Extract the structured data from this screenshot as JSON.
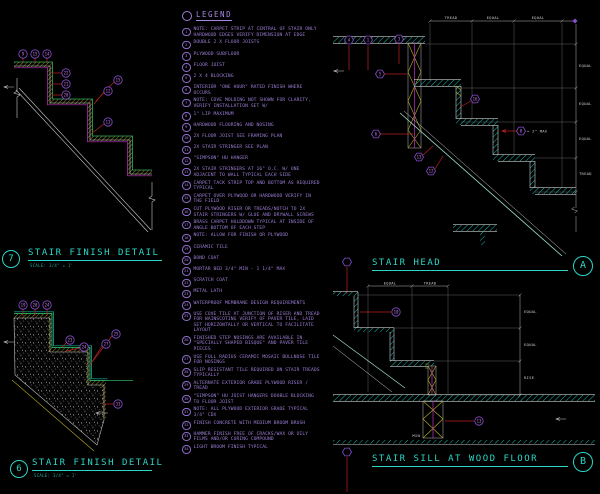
{
  "colors": {
    "background": "#000000",
    "title_cyan": "#2bd6c6",
    "legend_purple": "#9d7fd6",
    "balloon_purple": "#b05fd8",
    "leader_red": "#bb2222",
    "hatch_yellow": "#b9ae25",
    "line_white": "#c9c9c9",
    "tile_green": "#2fae5e",
    "line_magenta": "#c234c2"
  },
  "legend": {
    "title": "LEGEND",
    "items": [
      {
        "num": "1",
        "text": "NOTE: CARPET STRIP AT CENTRAL OF STAIR ONLY HARDWOOD EDGES VERIFY DIMENSION AT EDGE"
      },
      {
        "num": "2",
        "text": "DOUBLE 2 X FLOOR JOISTS"
      },
      {
        "num": "3",
        "text": "PLYWOOD SUBFLOOR"
      },
      {
        "num": "4",
        "text": "FLOOR JOIST"
      },
      {
        "num": "5",
        "text": "2 X 4 BLOCKING"
      },
      {
        "num": "6",
        "text": "INTERIOR \"ONE HOUR\" RATED FINISH WHERE OCCURS"
      },
      {
        "num": "7",
        "text": "NOTE: COVE MOLDING NOT SHOWN FOR CLARITY, VERIFY INSTALLATION SET W/"
      },
      {
        "num": "8",
        "text": "1\" LIP MAXIMUM"
      },
      {
        "num": "9",
        "text": "HARDWOOD FLOORING AND NOSING"
      },
      {
        "num": "10",
        "text": "2X FLOOR JOIST SEE FRAMING PLAN"
      },
      {
        "num": "11",
        "text": "2X STAIR STRINGER SEE PLAN"
      },
      {
        "num": "12",
        "text": "\"SIMPSON\" HU HANGER"
      },
      {
        "num": "13",
        "text": "2X STAIR STRINGERS AT 16\" O.C. W/ ONE ADJACENT TO WALL TYPICAL EACH SIDE"
      },
      {
        "num": "14",
        "text": "CARPET TACK STRIP TOP AND BOTTOM AS REQUIRED TYPICAL"
      },
      {
        "num": "15",
        "text": "CARPET OVER PLYWOOD OR HARDWOOD VERIFY IN THE FIELD"
      },
      {
        "num": "16",
        "text": "CUT PLYWOOD RISER OR TREADS/NOTCH TO 2X STAIR STRINGERS W/ GLUE AND DRYWALL SCREWS"
      },
      {
        "num": "17",
        "text": "BRASS CARPET HOLDDOWN TYPICAL AT INSIDE OF ANGLE BOTTOM OF EACH STEP"
      },
      {
        "num": "18",
        "text": "NOTE: ALLOW FOR FINISH OR PLYWOOD"
      },
      {
        "num": "19",
        "text": "CERAMIC TILE"
      },
      {
        "num": "20",
        "text": "BOND COAT"
      },
      {
        "num": "21",
        "text": "MORTAR BED 3/4\" MIN - 1 1/4\" MAX"
      },
      {
        "num": "22",
        "text": "SCRATCH COAT"
      },
      {
        "num": "23",
        "text": "METAL LATH"
      },
      {
        "num": "24",
        "text": "WATERPROOF MEMBRANE DESIGN REQUIREMENTS"
      },
      {
        "num": "25",
        "text": "USE COVE TILE AT JUNCTION OF RISER AND TREAD FOR WAINSCOTING VERIFY OF PAVER TILE, LAID SET HORIZONTALLY OR VERTICAL TO FACILITATE LAYOUT"
      },
      {
        "num": "26",
        "text": "FINISHED STEP NOSINGS ARE AVAILABLE IN \"SPECIALLY SHAPED BISQUE\" AND PAVER TILE PIECES"
      },
      {
        "num": "27",
        "text": "USE FULL RADIUS CERAMIC MOSAIC BULLNOSE TILE FOR NOSINGS"
      },
      {
        "num": "28",
        "text": "SLIP RESISTANT TILE REQUIRED ON STAIR TREADS TYPICALLY"
      },
      {
        "num": "29",
        "text": "ALTERNATE EXTERIOR GRADE PLYWOOD RISER / TREAD"
      },
      {
        "num": "30",
        "text": "\"SIMPSON\" HU JOIST HANGERS DOUBLE BLOCKING TO FLOOR JOIST"
      },
      {
        "num": "31",
        "text": "NOTE: ALL PLYWOOD EXTERIOR GRADE TYPICAL 3/4\" CDX"
      },
      {
        "num": "32",
        "text": "FINISH CONCRETE WITH MEDIUM BROOM BRUSH"
      },
      {
        "num": "33",
        "text": "HAMMER FINISH FREE OF CRACKS/WAX OR OILY FILMS AND/OR CURING COMPOUND"
      },
      {
        "num": "34",
        "text": "LIGHT BROOM FINISH TYPICAL"
      }
    ]
  },
  "details": {
    "d7": {
      "number": "7",
      "title": "STAIR FINISH DETAIL",
      "scale": "SCALE: 3/4\" = 1'",
      "balloons": [
        "9",
        "15",
        "14",
        "22",
        "21",
        "20",
        "15",
        "12",
        "13"
      ]
    },
    "d8": {
      "number": "6",
      "title": "STAIR FINISH DETAIL",
      "scale": "SCALE: 3/4\" = 1'",
      "balloons": [
        "19",
        "20",
        "24",
        "23",
        "24",
        "27",
        "25",
        "33"
      ]
    },
    "head": {
      "letter": "A",
      "title": "STAIR HEAD",
      "dims_top": [
        "TREAD",
        "EQUAL",
        "EQUAL"
      ],
      "dims_right": [
        "EQUAL",
        "EQUAL",
        "EQUAL",
        "TREAD"
      ],
      "note": "= 2\" MAX",
      "balloons": [
        "4",
        "1",
        "3",
        "5",
        "16",
        "6",
        "13",
        "12",
        "8"
      ],
      "flag": ""
    },
    "sill": {
      "letter": "B",
      "title": "STAIR SILL AT WOOD FLOOR",
      "dims_top": [
        "EQUAL",
        "TREAD"
      ],
      "dims_right": [
        "EQUAL",
        "EQUAL",
        "RISE"
      ],
      "min_label": "MIN",
      "balloons": [
        "10",
        "13"
      ],
      "flag": ""
    }
  }
}
